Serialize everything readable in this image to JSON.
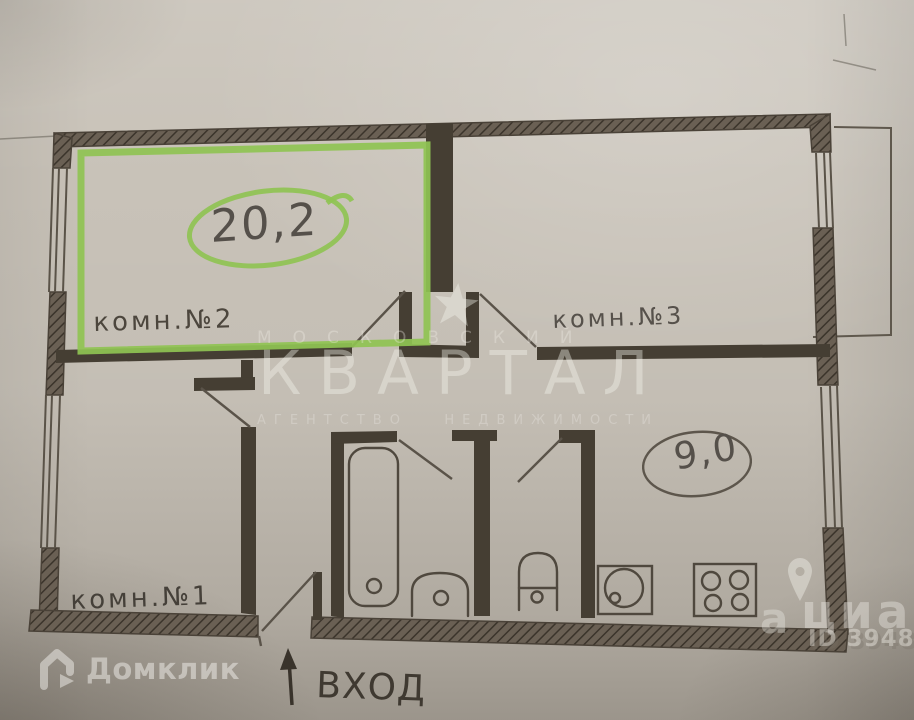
{
  "plan": {
    "rooms": {
      "room2": {
        "label": "комн.№2",
        "area": "20,2",
        "highlighted": true,
        "highlight_color": "#8fc353"
      },
      "room3": {
        "label": "комн.№3"
      },
      "room1": {
        "label": "комн.№1"
      },
      "kitchen": {
        "area": "9,0"
      }
    },
    "entrance": {
      "label": "ВХОД"
    }
  },
  "watermarks": {
    "agency_line1": "МОСКОВСКИЙ",
    "agency_name": "КВАРТАЛ",
    "agency_line2": "АГЕНТСТВО   НЕДВИЖИМОСТИ",
    "domclick": "Домклик",
    "cian_partial": "а",
    "cian": "циан",
    "listing_id": "ID 3948"
  },
  "colors": {
    "paper": "#c8c2b8",
    "pencil_wall": "#4a4238",
    "pencil_line": "#5d564c",
    "green_marker": "#8fc353",
    "watermark_white": "#f4f2ec"
  }
}
